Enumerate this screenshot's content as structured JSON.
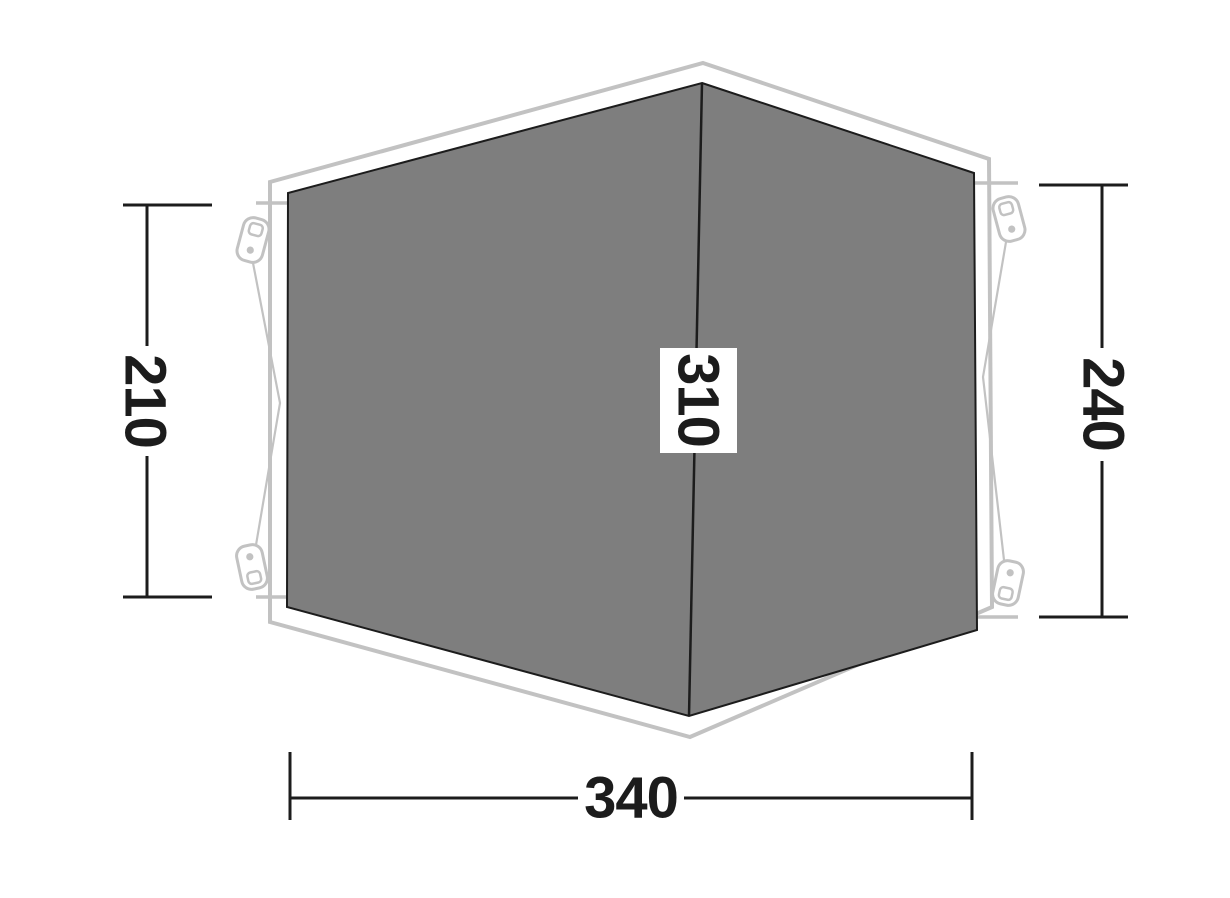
{
  "diagram": {
    "type": "tent-floorplan-dimension-diagram",
    "dimensions": {
      "left_height": "210",
      "right_height": "240",
      "center_depth": "310",
      "bottom_width": "340"
    },
    "colors": {
      "background": "#ffffff",
      "floor_fill": "#7e7e7e",
      "floor_stroke": "#1c1c1c",
      "outline": "#c2c2c2",
      "dimension": "#1c1c1c",
      "label_box": "#ffffff"
    },
    "icons": {
      "peg": "peg-icon"
    }
  }
}
